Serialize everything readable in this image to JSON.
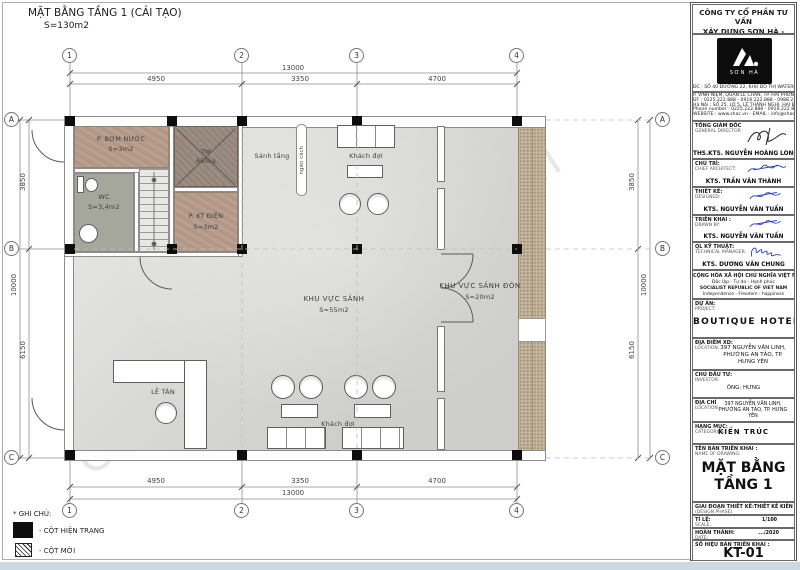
{
  "sheet": {
    "title": "MẶT BẰNG TẦNG 1 (CẢI TẠO)",
    "area": "S=130m2",
    "watermark": "Company Confidential"
  },
  "colors": {
    "floor": "#d9d9d6",
    "room_service": "#b29786",
    "room_wc": "#a6a79c",
    "elevator": "#9b8d82",
    "stone_band": "#c5b69d",
    "column": "#0d0d0d",
    "signature_blue": "#2b3fc0",
    "page_edge": "#cdd8e1"
  },
  "grid": {
    "cols": [
      "1",
      "2",
      "3",
      "4"
    ],
    "rows": [
      "A",
      "B",
      "C"
    ],
    "h_total": "13000",
    "h_segments": [
      "4950",
      "3350",
      "4700"
    ],
    "v_total": "10000",
    "v_segments": [
      "3850",
      "6150"
    ]
  },
  "rooms": {
    "pump": {
      "name": "P. BƠM NƯỚC",
      "area": "S=3m2"
    },
    "elevator": {
      "name": "TM",
      "load": "650kg"
    },
    "wc": {
      "name": "WC",
      "area": "S=3,4m2"
    },
    "electrical": {
      "name": "P. KT ĐIỆN",
      "area": "S=3m2"
    },
    "floor_hall": "Sảnh tầng",
    "partition": "ngăn cách",
    "waiting_top": "Khách đợi",
    "lobby": {
      "name": "KHU VỰC SẢNH",
      "area": "S=55m2"
    },
    "welcome": {
      "name": "KHU VỰC SẢNH ĐÓN",
      "area": "S=20m2"
    },
    "reception": "LỄ TÂN",
    "waiting_bottom": "Khách đợi"
  },
  "legend": {
    "title": "* GHI CHÚ:",
    "existing_column": "- CỘT HIỆN TRẠNG",
    "new_column": "- CỘT MỚI"
  },
  "titleblock": {
    "company_line1": "CÔNG TY CỔ PHẦN TƯ VẤN",
    "company_line2": "XÂY DỰNG SƠN HÀ - SHAC",
    "logo_text": "SƠN HÀ",
    "address_lines": [
      "ĐC : SỐ 40 ĐƯỜNG 22, KHU ĐÔ THỊ WATERFRONT CITY",
      "P. VĨNH NIỆM, QUẬN LÊ CHÂN, TP. HẢI PHÒNG",
      "ĐT : 0225.222.888 - 0916.222.888 - 0988.222.888",
      "Hà Nội : SỐ 25, LÔ 5, LÊ THÁNH NGHỊ, HAI BÀ TRƯNG",
      "Phone number : 0225.222.888 - 0916.222.888",
      "WEBSITE : www.shac.vn - EMAIL : info@shac.vn"
    ],
    "signatories": [
      {
        "role_vi": "TỔNG GIÁM ĐỐC",
        "role_en": "GENERAL DIRECTOR",
        "name": "THS.KTS. NGUYỄN HOÀNG LONG"
      },
      {
        "role_vi": "CHỦ TRÌ:",
        "role_en": "CHIEF ARCHITECT:",
        "name": "KTS. TRẦN VĂN THÀNH"
      },
      {
        "role_vi": "THIẾT KẾ:",
        "role_en": "DESIGNED:",
        "name": "KTS. NGUYỄN VĂN TUẤN"
      },
      {
        "role_vi": "TRIỂN KHAI :",
        "role_en": "DRAWN BY:",
        "name": "KTS. NGUYỄN VĂN TUẤN"
      },
      {
        "role_vi": "QL KỸ THUẬT:",
        "role_en": "TECHNICAL MANAGER:",
        "name": "KTS. DƯƠNG VĂN CHUNG"
      }
    ],
    "republic": {
      "line1": "CỘNG HÒA XÃ HỘI CHỦ NGHĨA VIỆT NAM",
      "line2": "Độc lập - Tự do - Hạnh phúc",
      "line3": "SOCIALIST REPUBLIC OF VIET NAM",
      "line4": "Independence - Freedom - happiness"
    },
    "project": {
      "label_vi": "DỰ ÁN:",
      "label_en": "PROJECT:",
      "value": "BOUTIQUE HOTEL"
    },
    "site": {
      "label_vi": "ĐỊA ĐIỂM XD:",
      "label_en": "LOCATION:",
      "value": "397 NGUYỄN VĂN LINH, PHƯỜNG AN TẢO, TP. HƯNG YÊN"
    },
    "investor": {
      "label_vi": "CHỦ ĐẦU TƯ:",
      "label_en": "INVESTOR:",
      "value": "ÔNG: HƯNG"
    },
    "investor_address": {
      "label_vi": "ĐỊA CHỈ",
      "label_en": "LOCATION:",
      "value": "397 NGUYỄN VĂN LINH, PHƯỜNG AN TẢO, TP. HƯNG YÊN"
    },
    "category": {
      "label_vi": "HẠNG MỤC:",
      "label_en": "CATEGORIES:",
      "value": "KIẾN TRÚC"
    },
    "drawing_name": {
      "label_vi": "TÊN BẢN TRIỂN KHAI :",
      "label_en": "NAME OF DRAWING:",
      "line1": "MẶT BẰNG",
      "line2": "TẦNG 1"
    },
    "phase": {
      "label_vi": "GIAI ĐOẠN THIẾT KẾ:",
      "label_en": "(DESIGN PHASE)",
      "value": "THIẾT KẾ KIẾN TRÚC"
    },
    "scale": {
      "label_vi": "TỈ LỆ:",
      "label_en": "SCALE:",
      "value": "1/100"
    },
    "completed": {
      "label_vi": "HOÀN THÀNH:",
      "label_en": "DATE:",
      "value": ".../2020"
    },
    "number": {
      "label_vi": "SỐ HIỆU BẢN TRIỂN KHAI :",
      "label_en": "TITLE OF DRAWING:",
      "value": "KT-01"
    }
  }
}
